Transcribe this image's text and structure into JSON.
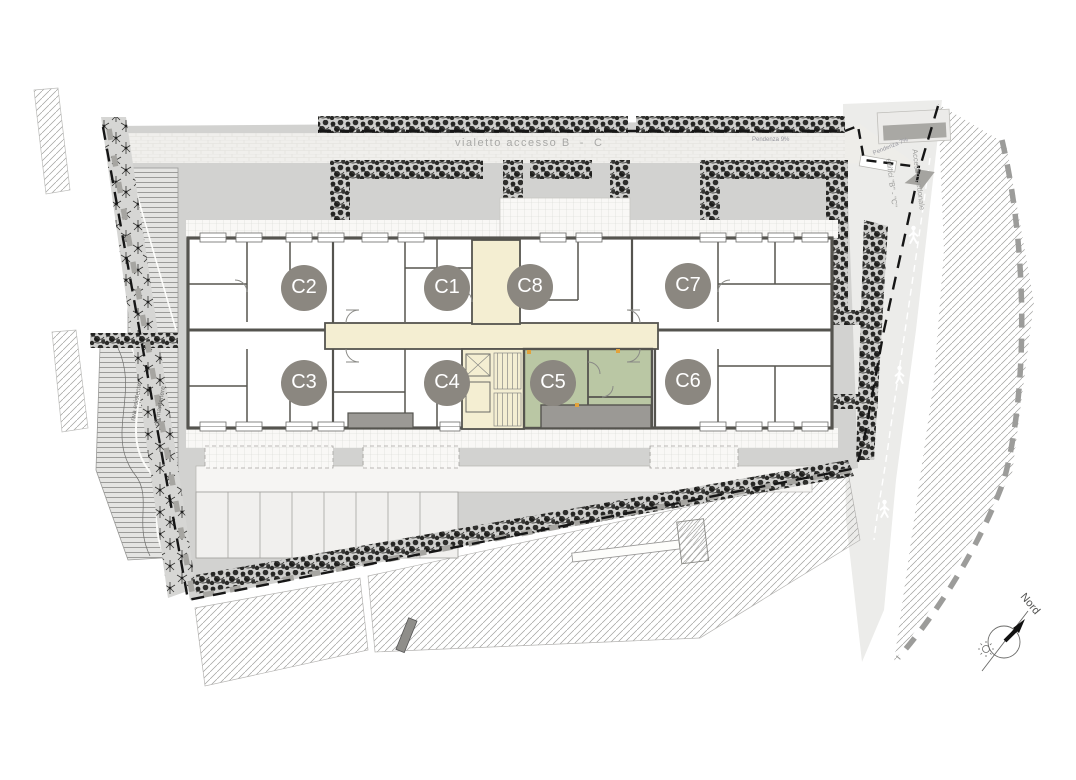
{
  "plan": {
    "title": "piantina piano - edificio C",
    "walkway_label": "vialetto accesso B  -  C",
    "slope_left_label": "Pendenza 9%",
    "slope_right_label": "Pendenza 7%",
    "pedestrian_access": {
      "line1": "Accesso pedonale",
      "line2": "edifici \"B\" - \"C\""
    },
    "bank_note": {
      "line1": "riva esistente",
      "line2": "da mantenere"
    },
    "north_label": "Nord",
    "units": [
      {
        "label": "C1",
        "highlighted": false
      },
      {
        "label": "C2",
        "highlighted": false
      },
      {
        "label": "C3",
        "highlighted": false
      },
      {
        "label": "C4",
        "highlighted": false
      },
      {
        "label": "C5",
        "highlighted": true
      },
      {
        "label": "C6",
        "highlighted": false
      },
      {
        "label": "C7",
        "highlighted": false
      },
      {
        "label": "C8",
        "highlighted": false
      }
    ],
    "colors": {
      "highlight_unit": "#bac7a4",
      "corridor": "#f4eed2",
      "badge": "#8b8780",
      "walls": "#55544f",
      "lawn": "#d2d2d0",
      "terrace": "#9b9995",
      "door_marker": "#e2a23b"
    }
  }
}
